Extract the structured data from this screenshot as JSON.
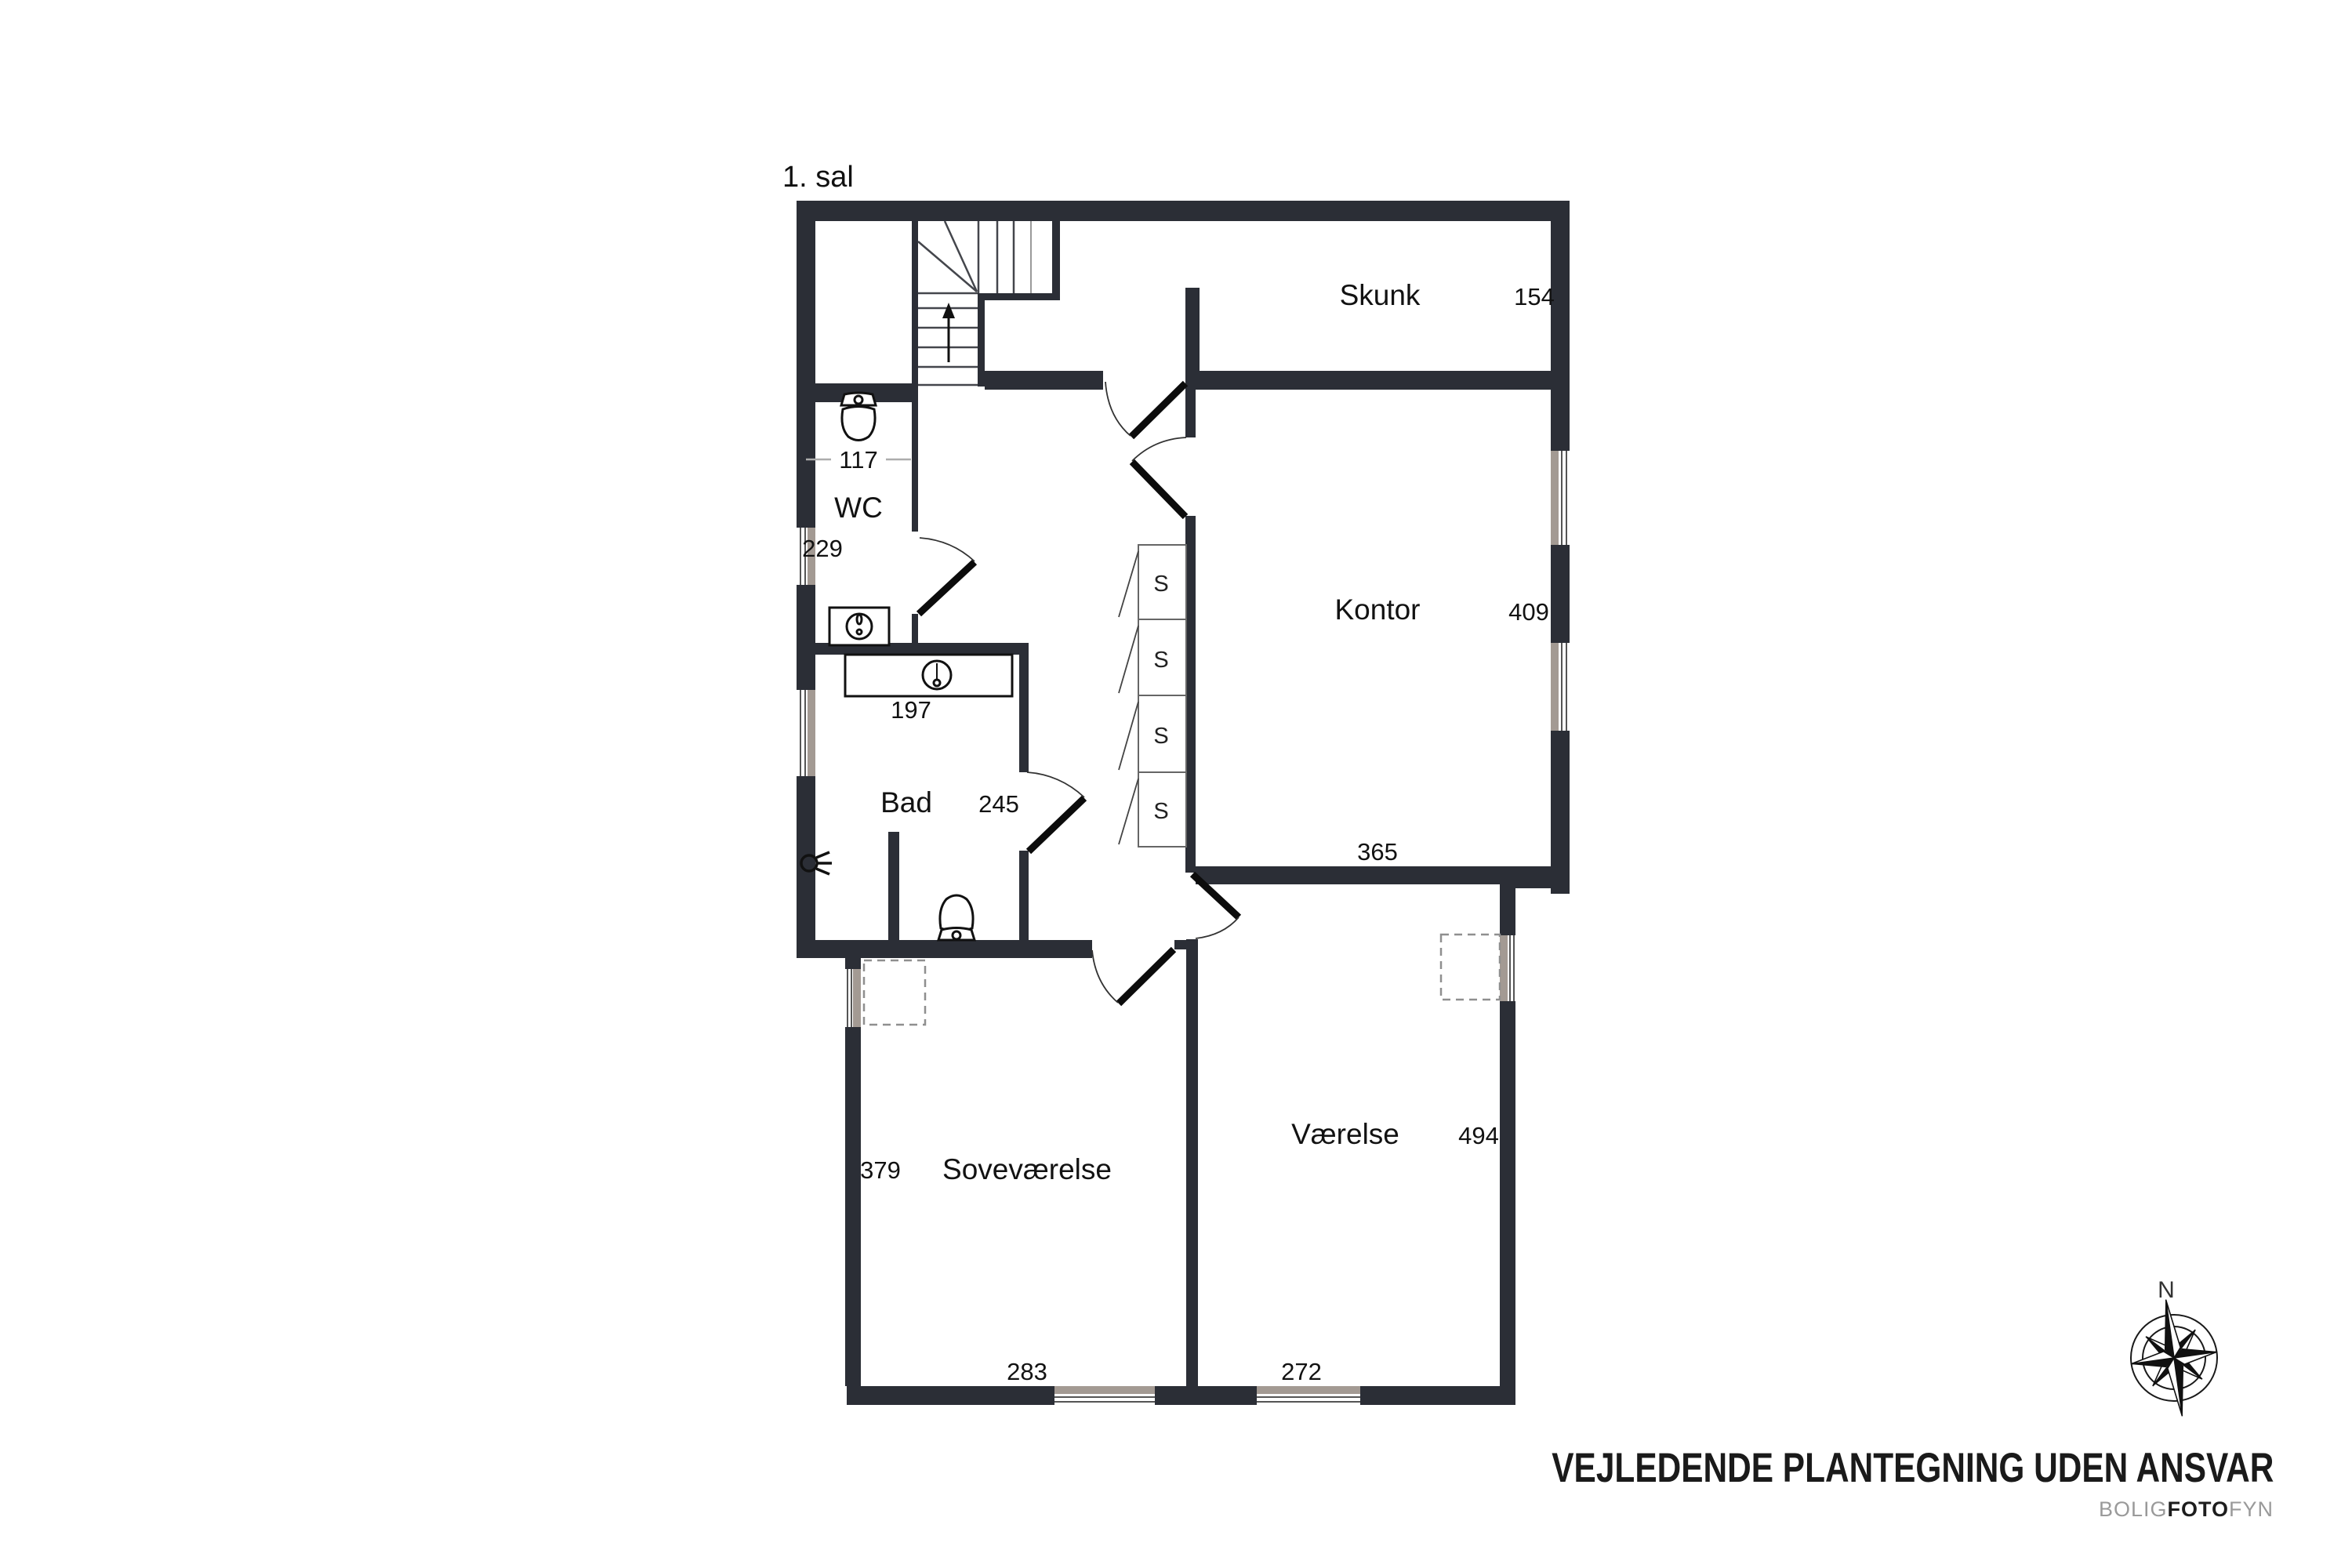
{
  "page": {
    "floor_title": "1. sal"
  },
  "plan": {
    "rooms": {
      "skunk": {
        "name": "Skunk",
        "dim": "154"
      },
      "wc": {
        "name": "WC",
        "dim_width": "117",
        "dim_height": "229"
      },
      "kontor": {
        "name": "Kontor",
        "dim_height": "409",
        "dim_width": "365"
      },
      "bad": {
        "name": "Bad",
        "dim": "245",
        "counter_dim": "197"
      },
      "sovevaerelse": {
        "name": "Soveværelse",
        "dim_height": "379",
        "dim_width": "283"
      },
      "vaerelse": {
        "name": "Værelse",
        "dim_height": "494",
        "dim_width": "272"
      }
    },
    "closet_label": "S",
    "compass": {
      "north_label": "N"
    },
    "fixtures": [
      "toilet-icon-wc",
      "toilet-icon-bad",
      "sink-icon-wc",
      "sink-icon-bad",
      "wall-lamp-icon",
      "stairs-up-arrow",
      "chimney-dashed-box",
      "compass-rose-icon"
    ]
  },
  "footer": {
    "disclaimer": "VEJLEDENDE PLANTEGNING UDEN ANSVAR",
    "brand": {
      "part1": "BOLIG",
      "part2": "FOTO",
      "part3": "FYN"
    }
  },
  "colors": {
    "wall": "#2b2e36",
    "window_gray": "#a39a93",
    "text": "#121212",
    "brand_light": "#9a9a9a",
    "brand_dark": "#1d1d1d"
  }
}
